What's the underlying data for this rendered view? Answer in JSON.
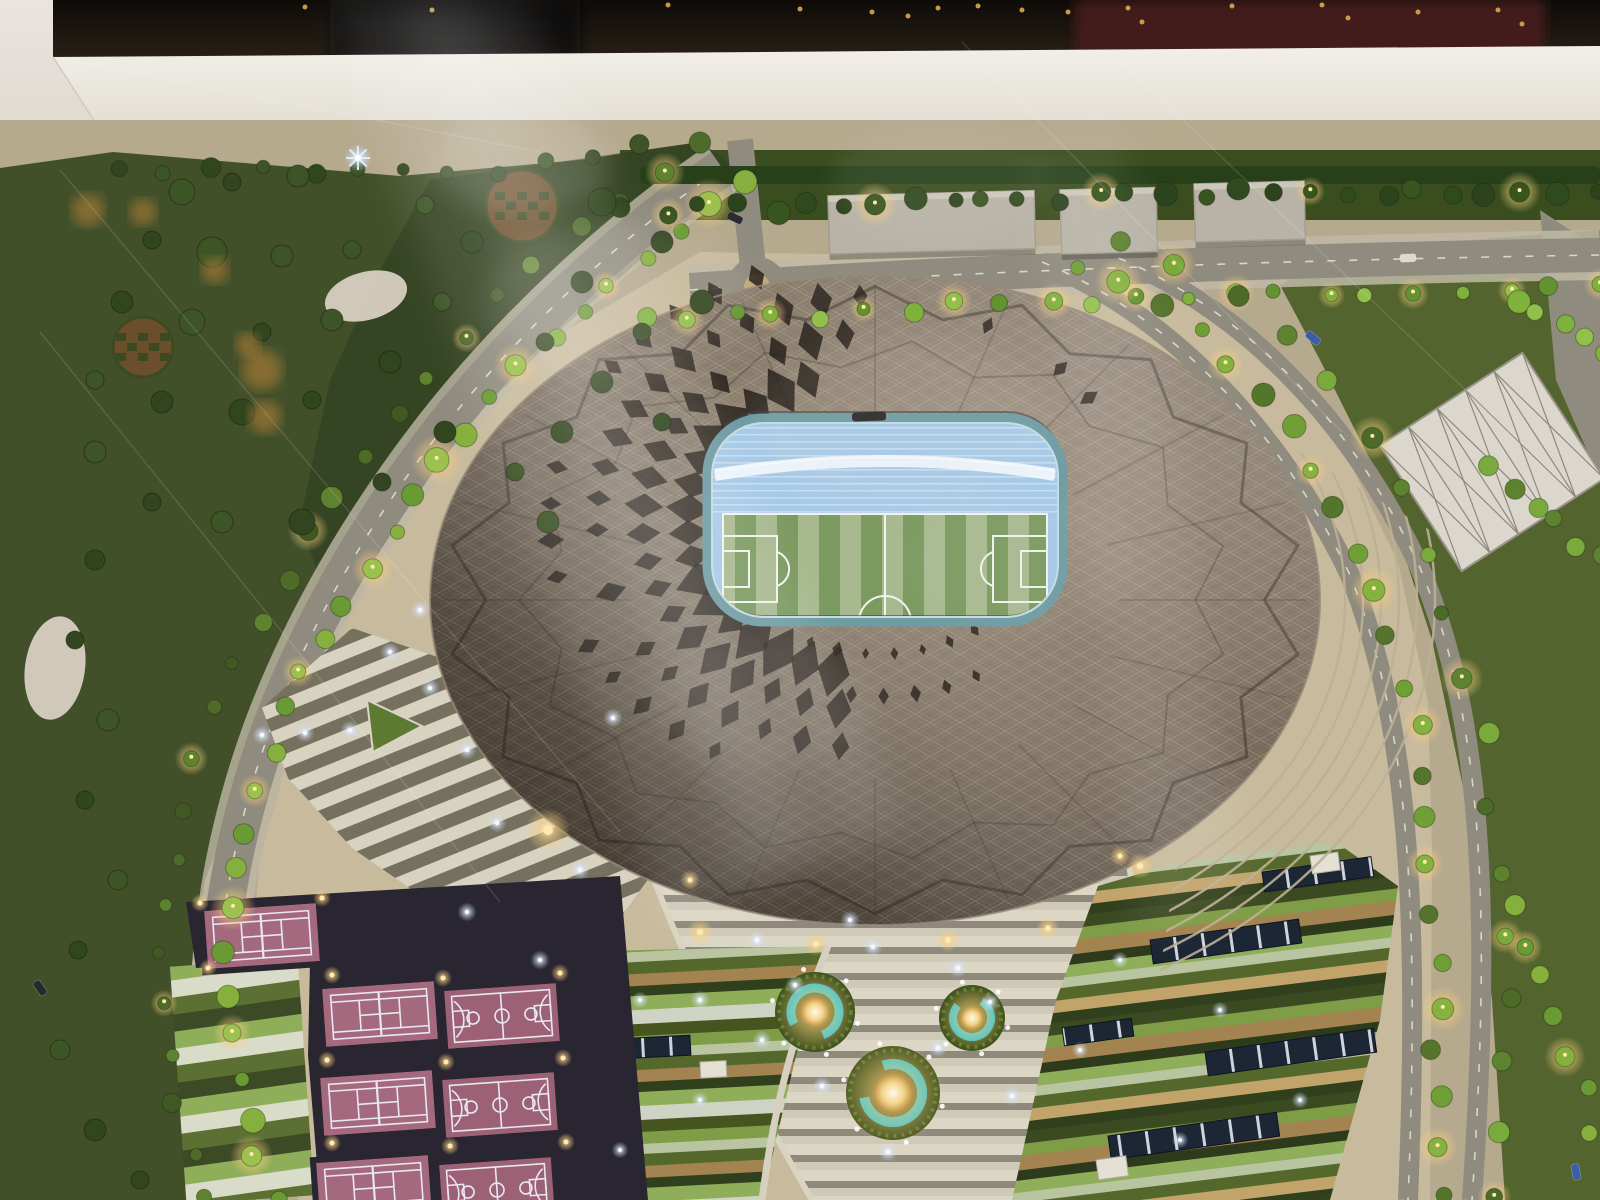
{
  "meta": {
    "description": "Night-lit architectural scale model of a diamond-patterned oval football stadium viewed from above through a glass display case, surrounded by tree-lined boulevards, sports courts, terraced gardens and glowing fountains"
  },
  "palette": {
    "caseWhite": "#f2efe8",
    "caseWhiteDim": "#d8d3c9",
    "caseWall": "#e9e5de",
    "caseFace": "#a9a399",
    "darkTop": "#14100c",
    "maroon": "#451f1f",
    "groundTan": "#b5a98e",
    "concourse": "#c8bb9d",
    "northGrass": "#3a4d1e",
    "parkGreen": "#42502a",
    "parkDark": "#2c3a1c",
    "fieldGreen": "#53642e",
    "road": "#8f8b7e",
    "roadDash": "#ebe8dc",
    "sidewalk": "#bfb8a6",
    "island": "#c2a87c",
    "stadiumHi": "#9e9181",
    "stadiumMid": "#7c7060",
    "stadiumLo": "#544a40",
    "holeDark": "#211b15",
    "rimDark": "#3a312a",
    "rimLight": "#978a77",
    "aqua": "#2ec4d7",
    "openingRing": "#6f9ba3",
    "openingRingHi": "#c3dde2",
    "bowlBlue": "#a6c9e7",
    "pitchA": "#a8b98f",
    "pitchB": "#7b9a60",
    "pitchLine": "#f0f3ec",
    "courtPink": "#a5697e",
    "courtPink2": "#9d6175",
    "courtLine": "#e9e7f4",
    "courtFrame": "#2a2631",
    "fountainGrass": "#42531f",
    "treeBright": "#85b03e",
    "treeDark": "#31461f",
    "hedge": "#27401a",
    "building": "#b8b3a6",
    "buildingEdge": "#a39e92",
    "gravel": "#d8d0c2",
    "checkBrown": "#6b4f2c",
    "checkGreen": "#3c4a22",
    "solarNavy": "#1c2634",
    "planter": "#5d7a33",
    "glowWarm": "#f7cf7f",
    "glowCool": "#cfe0ff",
    "lampDot": "#ffeab0",
    "ceilDot": "#d9a94e"
  },
  "vegetation": {
    "belts": [
      {
        "name": "left-boulevard-east",
        "pts": [
          [
            740,
            178
          ],
          [
            648,
            248
          ],
          [
            552,
            338
          ],
          [
            462,
            436
          ],
          [
            382,
            542
          ],
          [
            312,
            652
          ],
          [
            264,
            762
          ],
          [
            230,
            872
          ],
          [
            220,
            982
          ],
          [
            238,
            1090
          ],
          [
            272,
            1195
          ]
        ],
        "count": 30,
        "rmin": 7,
        "rmax": 13,
        "colors": [
          "#85b03e",
          "#9cc14e",
          "#6a9a33"
        ],
        "light": 3
      },
      {
        "name": "left-boulevard-west",
        "pts": [
          [
            700,
            148
          ],
          [
            596,
            214
          ],
          [
            492,
            306
          ],
          [
            402,
            408
          ],
          [
            320,
            518
          ],
          [
            252,
            630
          ],
          [
            202,
            748
          ],
          [
            170,
            866
          ],
          [
            158,
            984
          ],
          [
            176,
            1098
          ],
          [
            210,
            1200
          ]
        ],
        "count": 26,
        "rmin": 6,
        "rmax": 11,
        "colors": [
          "#4e6b2a",
          "#5f8230",
          "#425824"
        ],
        "light": 5
      },
      {
        "name": "north-hedge",
        "pts": [
          [
            628,
            212
          ],
          [
            1000,
            200
          ],
          [
            1300,
            193
          ],
          [
            1598,
            188
          ]
        ],
        "count": 28,
        "rmin": 7,
        "rmax": 12,
        "colors": [
          "#2c441d",
          "#38541f",
          "#2f4a1e"
        ],
        "light": 6
      },
      {
        "name": "north-road-trees",
        "pts": [
          [
            640,
            322
          ],
          [
            1000,
            305
          ],
          [
            1300,
            296
          ],
          [
            1598,
            288
          ]
        ],
        "count": 22,
        "rmin": 6,
        "rmax": 10,
        "colors": [
          "#7fb23c",
          "#92c14b",
          "#639230"
        ],
        "light": 2
      },
      {
        "name": "right-boulevard-median",
        "pts": [
          [
            1070,
            268
          ],
          [
            1190,
            322
          ],
          [
            1298,
            432
          ],
          [
            1368,
            560
          ],
          [
            1412,
            700
          ],
          [
            1430,
            850
          ],
          [
            1438,
            1020
          ],
          [
            1440,
            1195
          ]
        ],
        "count": 24,
        "rmin": 7,
        "rmax": 12,
        "colors": [
          "#6f9f35",
          "#86b23f",
          "#55742c"
        ],
        "light": 3
      },
      {
        "name": "right-boulevard-east",
        "pts": [
          [
            1118,
            238
          ],
          [
            1248,
            296
          ],
          [
            1358,
            412
          ],
          [
            1430,
            556
          ],
          [
            1480,
            712
          ],
          [
            1500,
            880
          ],
          [
            1508,
            1040
          ],
          [
            1500,
            1195
          ]
        ],
        "count": 18,
        "rmin": 7,
        "rmax": 11,
        "colors": [
          "#5d8230",
          "#7aa93c",
          "#4c6b28"
        ],
        "light": 4
      },
      {
        "name": "far-right-row-1",
        "pts": [
          [
            1518,
            300
          ],
          [
            1598,
            352
          ]
        ],
        "count": 5,
        "rmin": 8,
        "rmax": 12,
        "colors": [
          "#7fb23c",
          "#92c14b"
        ],
        "light": 0
      },
      {
        "name": "far-right-row-2",
        "pts": [
          [
            1492,
            470
          ],
          [
            1598,
            560
          ]
        ],
        "count": 6,
        "rmin": 8,
        "rmax": 12,
        "colors": [
          "#7aa93c",
          "#5d8230"
        ],
        "light": 0
      },
      {
        "name": "far-right-row-3",
        "pts": [
          [
            1508,
            906
          ],
          [
            1560,
            1020
          ],
          [
            1595,
            1130
          ]
        ],
        "count": 7,
        "rmin": 8,
        "rmax": 12,
        "colors": [
          "#85b03e",
          "#6a9a33"
        ],
        "light": 3
      },
      {
        "name": "park-top-edge",
        "pts": [
          [
            120,
            172
          ],
          [
            300,
            168
          ],
          [
            480,
            172
          ],
          [
            640,
            150
          ]
        ],
        "count": 12,
        "rmin": 6,
        "rmax": 10,
        "colors": [
          "#31461f",
          "#3c5426"
        ],
        "light": 0
      }
    ],
    "park_clusters": [
      [
        182,
        192,
        13
      ],
      [
        232,
        182,
        9
      ],
      [
        298,
        176,
        11
      ],
      [
        152,
        240,
        9
      ],
      [
        212,
        252,
        15
      ],
      [
        282,
        256,
        11
      ],
      [
        352,
        250,
        9
      ],
      [
        122,
        302,
        11
      ],
      [
        192,
        322,
        13
      ],
      [
        262,
        332,
        9
      ],
      [
        332,
        320,
        11
      ],
      [
        95,
        380,
        9
      ],
      [
        162,
        402,
        11
      ],
      [
        242,
        412,
        13
      ],
      [
        312,
        400,
        9
      ],
      [
        390,
        362,
        11
      ],
      [
        442,
        302,
        9
      ],
      [
        472,
        242,
        11
      ],
      [
        425,
        205,
        9
      ],
      [
        95,
        452,
        11
      ],
      [
        152,
        502,
        9
      ],
      [
        222,
        522,
        11
      ],
      [
        302,
        522,
        13
      ],
      [
        382,
        482,
        9
      ],
      [
        445,
        432,
        11
      ],
      [
        602,
        202,
        14
      ],
      [
        662,
        242,
        11
      ],
      [
        702,
        302,
        12
      ],
      [
        642,
        332,
        9
      ],
      [
        582,
        282,
        11
      ],
      [
        545,
        342,
        9
      ],
      [
        602,
        382,
        11
      ],
      [
        662,
        422,
        9
      ],
      [
        562,
        432,
        11
      ],
      [
        515,
        472,
        9
      ],
      [
        548,
        522,
        11
      ],
      [
        95,
        560,
        10
      ],
      [
        75,
        640,
        9
      ],
      [
        108,
        720,
        11
      ],
      [
        85,
        800,
        9
      ],
      [
        118,
        880,
        10
      ],
      [
        78,
        950,
        9
      ],
      [
        60,
        1050,
        10
      ],
      [
        95,
        1130,
        11
      ],
      [
        140,
        1180,
        9
      ]
    ],
    "checker_plots": [
      {
        "cx": 522,
        "cy": 206,
        "r": 36
      },
      {
        "cx": 143,
        "cy": 347,
        "r": 30
      }
    ],
    "gravel_patches": [
      {
        "cx": 366,
        "cy": 296,
        "rx": 42,
        "ry": 24,
        "rot": -15
      },
      {
        "cx": 55,
        "cy": 668,
        "rx": 30,
        "ry": 52,
        "rot": 8
      }
    ]
  },
  "stadium": {
    "cx": 875,
    "cy": 600,
    "rx": 445,
    "ry": 325,
    "opening_center": [
      880,
      522
    ],
    "hole_rings": [
      {
        "r": 192,
        "sq": 0.8,
        "a0": 104,
        "a1": 262,
        "step": 9,
        "s": 23
      },
      {
        "r": 237,
        "sq": 0.8,
        "a0": 100,
        "a1": 266,
        "step": 8.5,
        "s": 19
      },
      {
        "r": 283,
        "sq": 0.8,
        "a0": 98,
        "a1": 268,
        "step": 8,
        "s": 15
      },
      {
        "r": 330,
        "sq": 0.8,
        "a0": 120,
        "a1": 250,
        "step": 8,
        "s": 11
      },
      {
        "r": 165,
        "sq": 0.8,
        "a0": 55,
        "a1": 125,
        "step": 10,
        "s": 7
      },
      {
        "r": 205,
        "sq": 0.85,
        "a0": 62,
        "a1": 100,
        "step": 9,
        "s": 8
      },
      {
        "r": 255,
        "sq": 0.85,
        "a0": 285,
        "a1": 330,
        "step": 10,
        "s": 9
      }
    ],
    "facet_lines": 20
  },
  "courts": {
    "items": [
      {
        "type": "tennis",
        "cx": 262,
        "cy": 936,
        "rot": -4
      },
      {
        "type": "tennis",
        "cx": 380,
        "cy": 1014,
        "rot": -4
      },
      {
        "type": "basket",
        "cx": 502,
        "cy": 1016,
        "rot": -4
      },
      {
        "type": "tennis",
        "cx": 378,
        "cy": 1103,
        "rot": -4
      },
      {
        "type": "basket",
        "cx": 500,
        "cy": 1105,
        "rot": -4
      },
      {
        "type": "tennis",
        "cx": 374,
        "cy": 1188,
        "rot": -4
      },
      {
        "type": "basket",
        "cx": 497,
        "cy": 1190,
        "rot": -4
      }
    ],
    "lamp_dots": [
      [
        200,
        903
      ],
      [
        322,
        898
      ],
      [
        332,
        975
      ],
      [
        443,
        978
      ],
      [
        560,
        973
      ],
      [
        327,
        1060
      ],
      [
        446,
        1062
      ],
      [
        563,
        1058
      ],
      [
        332,
        1143
      ],
      [
        450,
        1146
      ],
      [
        566,
        1142
      ],
      [
        208,
        968
      ]
    ]
  },
  "fountains": [
    {
      "cx": 815,
      "cy": 1012,
      "rGrass": 40,
      "rRing": 24,
      "ringW": 9,
      "rDome": 15,
      "gapRot": 150
    },
    {
      "cx": 972,
      "cy": 1018,
      "rGrass": 33,
      "rRing": 19,
      "ringW": 8,
      "rDome": 12,
      "gapRot": 300
    },
    {
      "cx": 893,
      "cy": 1093,
      "rGrass": 47,
      "rRing": 29,
      "ringW": 10,
      "rDome": 20,
      "gapRot": 250
    }
  ],
  "solar_arrays": [
    {
      "x": 1150,
      "y": 940,
      "w": 150,
      "h": 24,
      "rot": -8
    },
    {
      "x": 1205,
      "y": 1052,
      "w": 170,
      "h": 24,
      "rot": -8
    },
    {
      "x": 1108,
      "y": 1136,
      "w": 170,
      "h": 24,
      "rot": -8
    },
    {
      "x": 1262,
      "y": 872,
      "w": 110,
      "h": 20,
      "rot": -8
    },
    {
      "x": 1062,
      "y": 1028,
      "w": 70,
      "h": 18,
      "rot": -8
    },
    {
      "x": 598,
      "y": 1040,
      "w": 92,
      "h": 20,
      "rot": -3
    }
  ],
  "white_pads": [
    {
      "x": 1310,
      "y": 856,
      "w": 28,
      "h": 18,
      "rot": -8
    },
    {
      "x": 1096,
      "y": 1160,
      "w": 30,
      "h": 20,
      "rot": -8
    },
    {
      "x": 590,
      "y": 968,
      "w": 26,
      "h": 16,
      "rot": -3
    },
    {
      "x": 700,
      "y": 1062,
      "w": 26,
      "h": 16,
      "rot": -3
    }
  ],
  "buildings": [
    {
      "x": 828,
      "y": 196,
      "w": 206,
      "h": 58,
      "rot": -1.5
    },
    {
      "x": 1060,
      "y": 190,
      "w": 96,
      "h": 64,
      "rot": -1.5
    },
    {
      "x": 1194,
      "y": 184,
      "w": 110,
      "h": 58,
      "rot": -1.5
    }
  ],
  "lights": {
    "warm": [
      [
        548,
        830,
        22
      ],
      [
        700,
        932,
        13
      ],
      [
        816,
        944,
        12
      ],
      [
        948,
        940,
        12
      ],
      [
        1048,
        928,
        12
      ],
      [
        1140,
        866,
        13
      ],
      [
        690,
        880,
        10
      ],
      [
        1120,
        856,
        10
      ]
    ],
    "cool": [
      [
        390,
        652,
        4
      ],
      [
        350,
        730,
        4
      ],
      [
        305,
        733,
        4
      ],
      [
        467,
        750,
        4
      ],
      [
        497,
        823,
        4
      ],
      [
        580,
        870,
        4
      ],
      [
        467,
        912,
        4
      ],
      [
        430,
        688,
        4
      ],
      [
        262,
        735,
        4
      ],
      [
        540,
        960,
        4
      ],
      [
        757,
        940,
        4
      ],
      [
        795,
        985,
        4
      ],
      [
        873,
        947,
        4
      ],
      [
        958,
        968,
        4
      ],
      [
        990,
        1002,
        4
      ],
      [
        938,
        1048,
        4
      ],
      [
        888,
        1152,
        4
      ],
      [
        822,
        1086,
        4
      ],
      [
        762,
        1040,
        4
      ],
      [
        1012,
        1096,
        4
      ],
      [
        700,
        1000,
        4
      ],
      [
        850,
        920,
        4
      ],
      [
        640,
        1000,
        3.5
      ],
      [
        700,
        1100,
        3.5
      ],
      [
        620,
        1150,
        3.5
      ],
      [
        1120,
        960,
        3.5
      ],
      [
        1220,
        1010,
        3.5
      ],
      [
        1300,
        1100,
        3.5
      ],
      [
        1180,
        1140,
        3.5
      ],
      [
        1080,
        1050,
        3.5
      ],
      [
        613,
        718,
        4
      ],
      [
        420,
        610,
        4
      ]
    ],
    "ceiling_dots": [
      [
        872,
        12
      ],
      [
        908,
        16
      ],
      [
        938,
        8
      ],
      [
        978,
        6
      ],
      [
        1022,
        10
      ],
      [
        1068,
        12
      ],
      [
        1128,
        8
      ],
      [
        1142,
        22
      ],
      [
        1232,
        6
      ],
      [
        1322,
        5
      ],
      [
        1348,
        18
      ],
      [
        1418,
        12
      ],
      [
        1498,
        10
      ],
      [
        1522,
        24
      ],
      [
        432,
        10
      ],
      [
        305,
        7
      ],
      [
        668,
        5
      ],
      [
        800,
        9
      ]
    ],
    "sparkle": [
      358,
      158
    ],
    "orange_blobs": [
      [
        88,
        210,
        16
      ],
      [
        143,
        212,
        13
      ],
      [
        215,
        270,
        13
      ],
      [
        262,
        370,
        20
      ],
      [
        265,
        417,
        16
      ],
      [
        248,
        345,
        12
      ]
    ]
  },
  "cars": [
    {
      "x": 735,
      "y": 218,
      "rot": 25,
      "color": "#2b2b30"
    },
    {
      "x": 1313,
      "y": 338,
      "rot": 40,
      "color": "#3a5ea8"
    },
    {
      "x": 1408,
      "y": 258,
      "rot": -3,
      "color": "#ded9cf"
    },
    {
      "x": 1576,
      "y": 1172,
      "rot": 80,
      "color": "#3a5ea8"
    },
    {
      "x": 40,
      "y": 988,
      "rot": 55,
      "color": "#26282e"
    }
  ],
  "reflections": {
    "streaks": [
      {
        "pts": "330,0 520,0 905,830 672,925",
        "op": 0.1
      },
      {
        "pts": "392,0 470,0 812,852 742,878",
        "op": 0.09
      },
      {
        "pts": "1026,142 1122,132 1248,902 1142,932",
        "op": 0.07
      }
    ],
    "haze": [
      [
        618,
        300,
        135,
        78,
        0.1
      ],
      [
        905,
        425,
        150,
        88,
        0.07
      ],
      [
        520,
        162,
        92,
        50,
        0.12
      ],
      [
        1022,
        562,
        122,
        70,
        0.05
      ],
      [
        762,
        702,
        122,
        62,
        0.05
      ],
      [
        940,
        180,
        110,
        55,
        0.08
      ]
    ],
    "scratches": [
      [
        60,
        170,
        620,
        832
      ],
      [
        40,
        332,
        500,
        902
      ],
      [
        962,
        42,
        1342,
        432
      ],
      [
        1122,
        62,
        1562,
        482
      ],
      [
        53,
        57,
        540,
        152
      ]
    ]
  }
}
